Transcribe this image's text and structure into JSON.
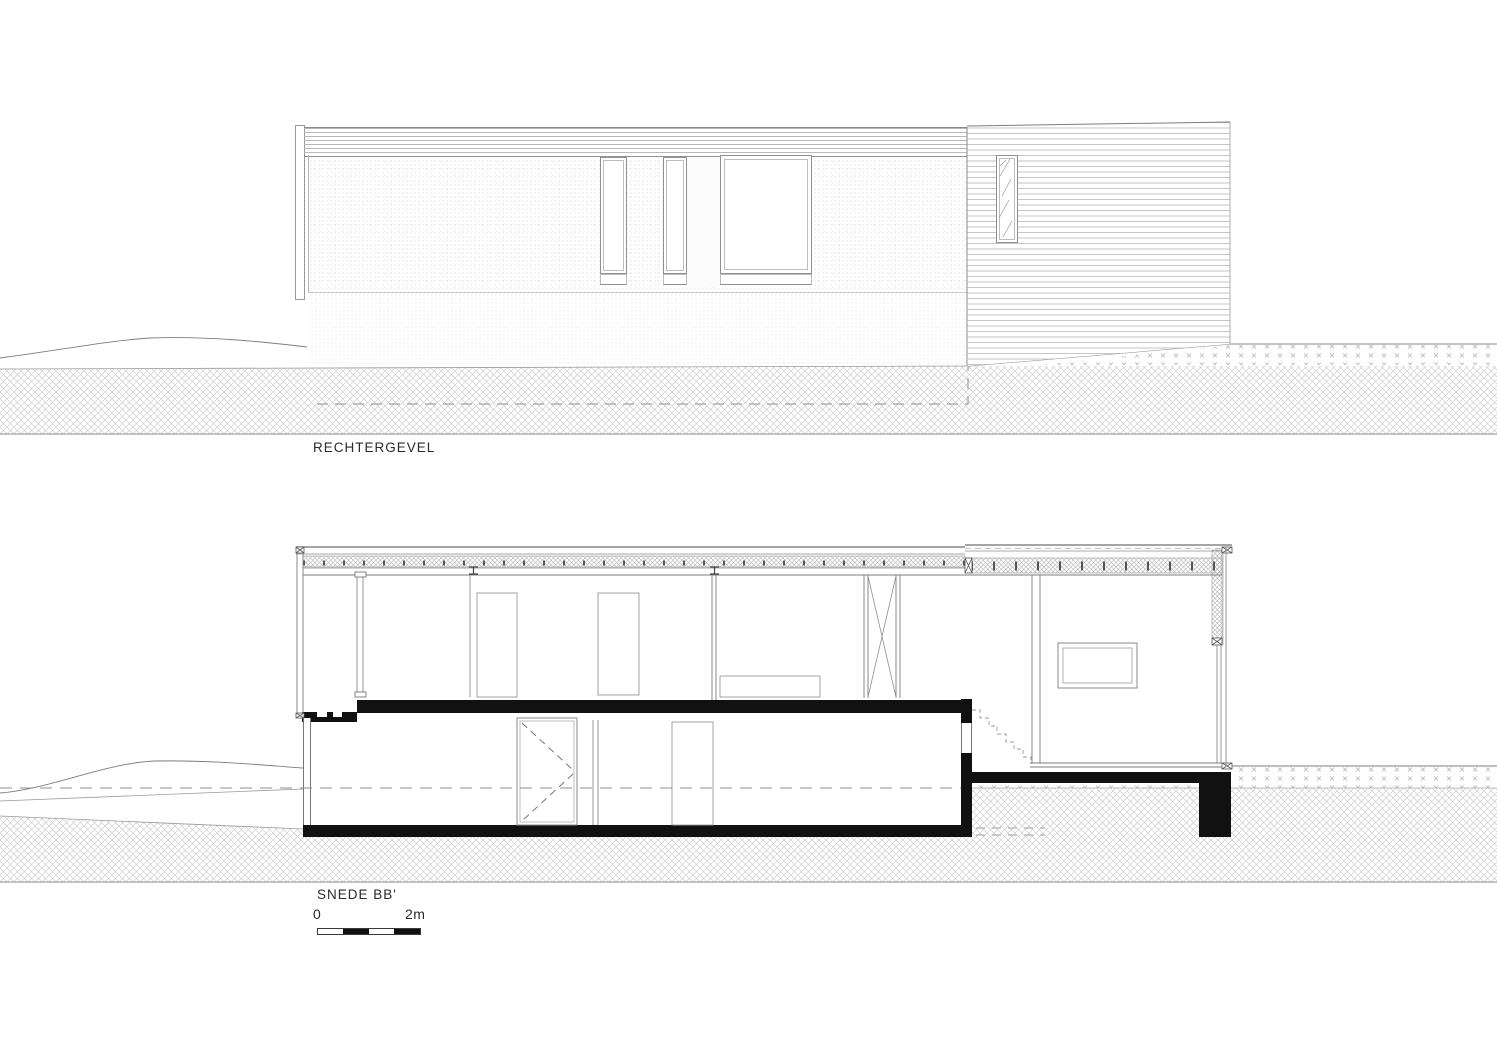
{
  "elevation": {
    "label": "RECHTERGEVEL"
  },
  "section": {
    "label": "SNEDE BB'",
    "scale": {
      "zero": "0",
      "two_m": "2m"
    }
  }
}
